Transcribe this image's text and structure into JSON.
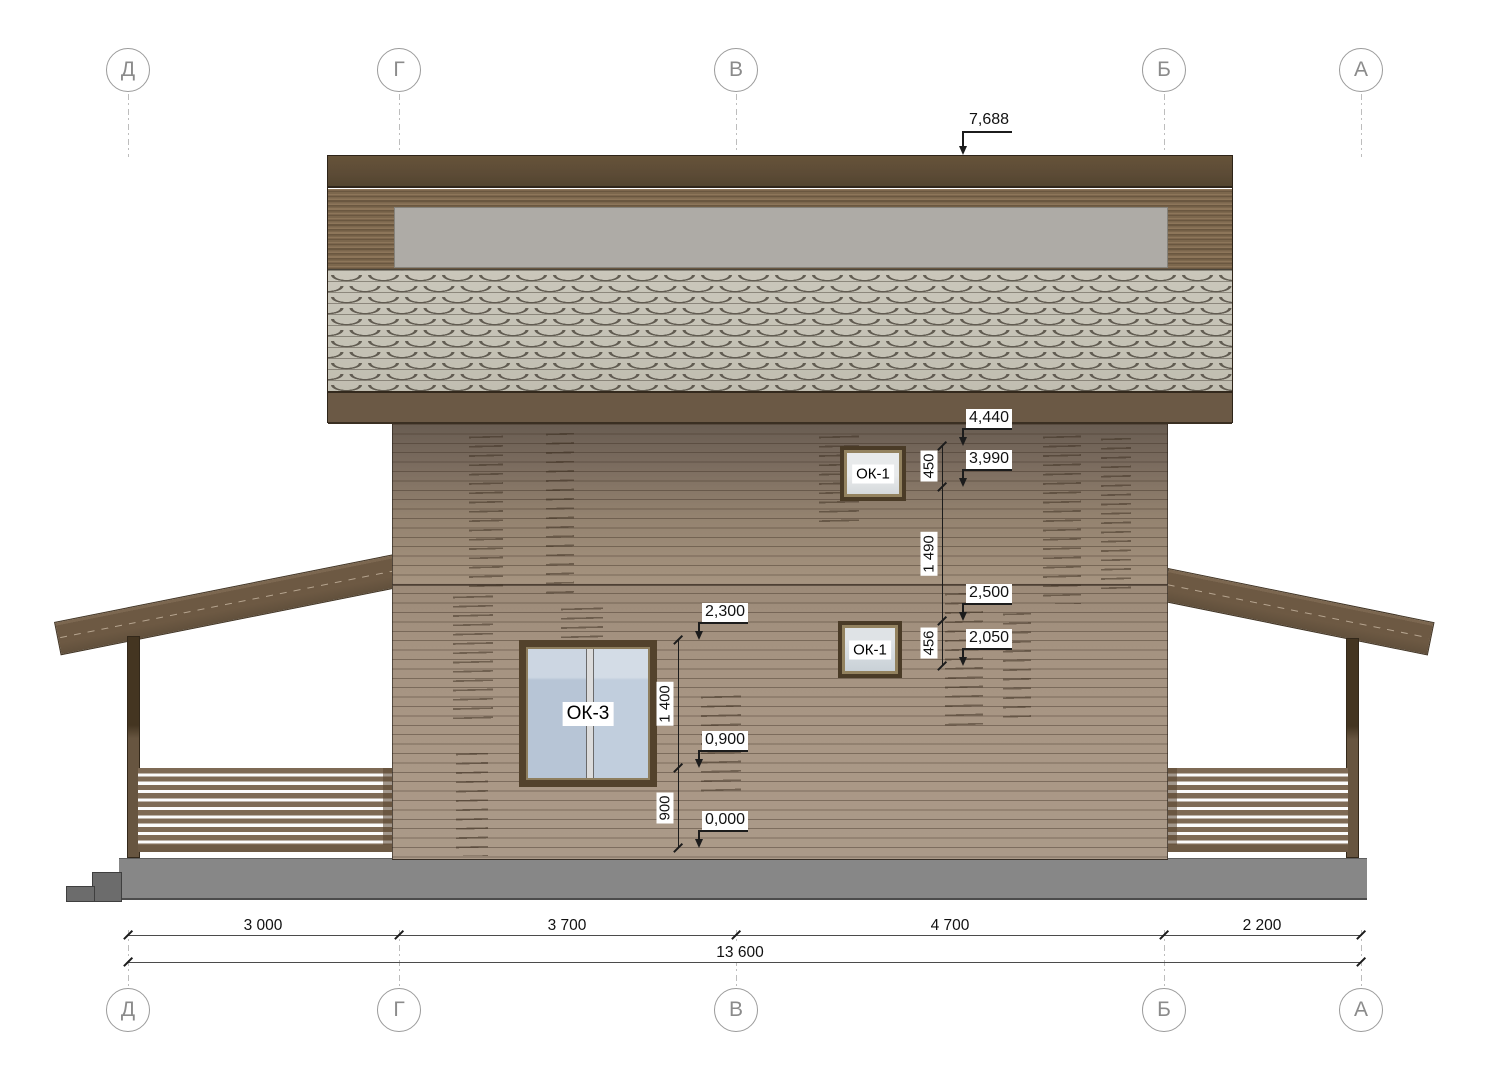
{
  "axes": {
    "labels": [
      "Д",
      "Г",
      "В",
      "Б",
      "А"
    ]
  },
  "elevations": {
    "roof_top": "7,688",
    "ok1_upper_top": "4,440",
    "ok1_upper_bottom": "3,990",
    "ok1_lower_top": "2,500",
    "ok1_lower_bottom": "2,050",
    "ok3_top": "2,300",
    "ok3_bottom": "0,900",
    "ground": "0,000"
  },
  "dims": {
    "ok1_upper_height": "450",
    "between_windows": "1 490",
    "ok1_lower_height": "456",
    "ok3_height": "1 400",
    "ok3_sill": "900",
    "span_d_g": "3 000",
    "span_g_v": "3 700",
    "span_v_b": "4 700",
    "span_b_a": "2 200",
    "total": "13 600"
  },
  "windows": {
    "ok1_upper": "ОК-1",
    "ok1_lower": "ОК-1",
    "ok3": "ОК-3"
  },
  "palette": {
    "fascia": "#5c4b36",
    "roof_shingle": "#c5c2b6",
    "gutter": "#aeaba6",
    "wall": "#a29080",
    "beam": "#6d5943",
    "foundation": "#878787"
  }
}
